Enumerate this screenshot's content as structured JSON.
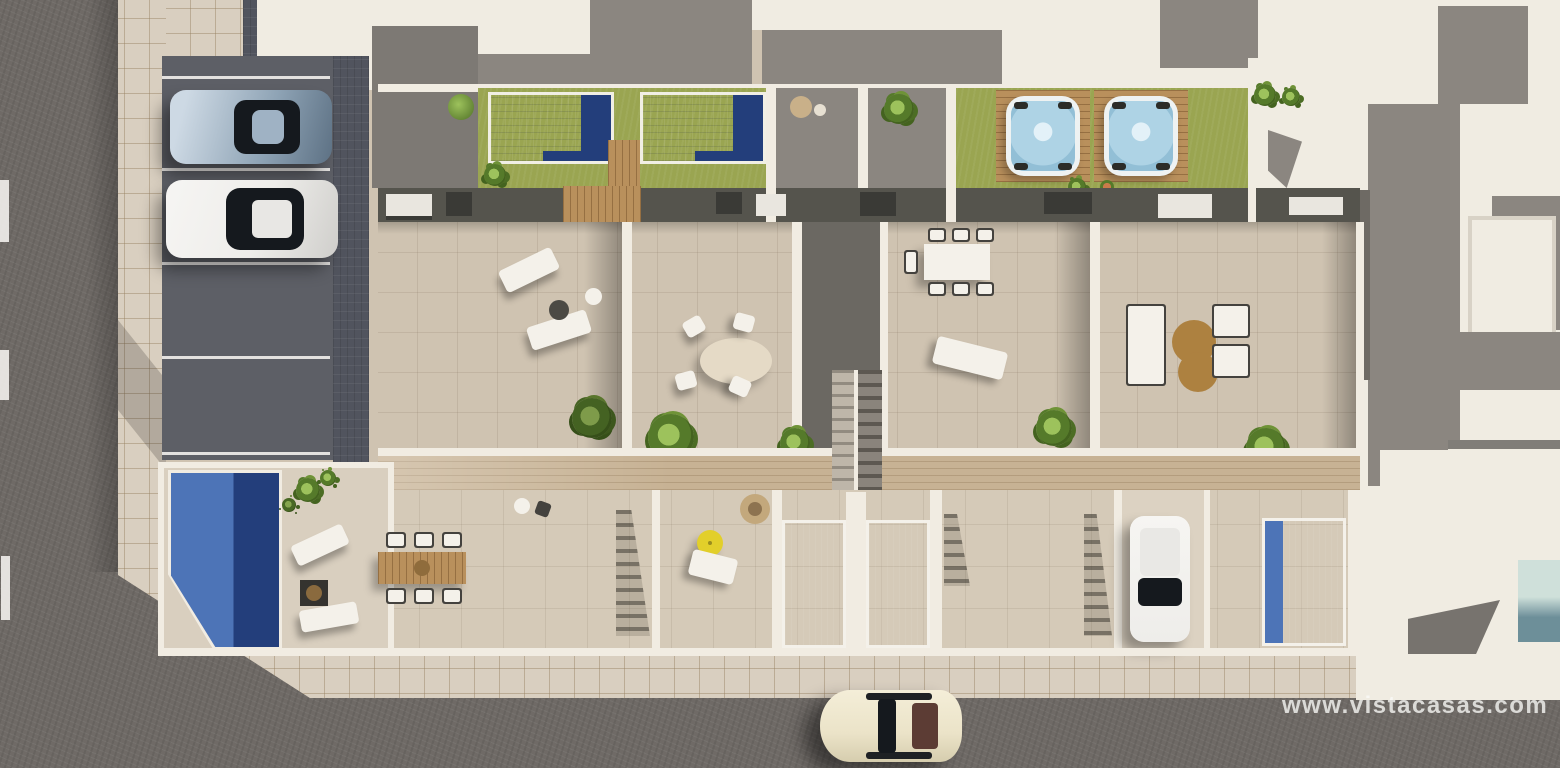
{
  "watermark": {
    "text": "www.vistacasas.com"
  },
  "scene": {
    "type": "aerial-architectural-render",
    "objects": {
      "roads": "asphalt street left and bottom",
      "parking": "parking bays with silver sports car and white car",
      "rooftop_pools": "two tiled pools with wood decks and lawns",
      "hot_tubs": "two spa hot tubs on wood platforms in lawn",
      "roof_terraces": "four tiled roof terraces with outdoor furniture",
      "ground_patios": "ground floor patios with plunge pools",
      "driveway_car": "white car parked in private driveway",
      "street_car": "cream classic car driving on bottom road",
      "neighbours": "white and gray neighbouring rooftops top and right"
    }
  },
  "colors": {
    "roadAsphalt": "#6f6a66",
    "laneMarking": "#ddd8d0",
    "sidewalkTile": "#d9cfc0",
    "parkingAsphalt": "#5d5f66",
    "paverStrip": "#51545e",
    "wallWhite": "#f1ece2",
    "roofGray": "#7d7974",
    "neighborGray": "#8b8680",
    "neighborWhite": "#f0ece2",
    "terraceTile": "#cfc3b1",
    "patioTile": "#d5cab8",
    "deckTile": "#d9cfbf",
    "grass": "#9aa551",
    "poolLight": "#4d74b7",
    "poolDark": "#233e7b",
    "tubWater": "#aed3e5",
    "tubRim": "#eef2f2",
    "woodDeck": "#b9905c",
    "woodWalkway": "#c7b294",
    "tableWood": "#c9a06a",
    "furnitureWhite": "#f4f1ea",
    "furnitureDark": "#44423e",
    "loungeTan": "#ad8140",
    "umbrellaYellow": "#e2cf2a",
    "carSilver": "#8ea3b5",
    "carWhite": "#eeedea",
    "carCream": "#ebe3c8",
    "carGlass": "#15191e",
    "watermark": "rgba(250,250,247,0.78)"
  }
}
